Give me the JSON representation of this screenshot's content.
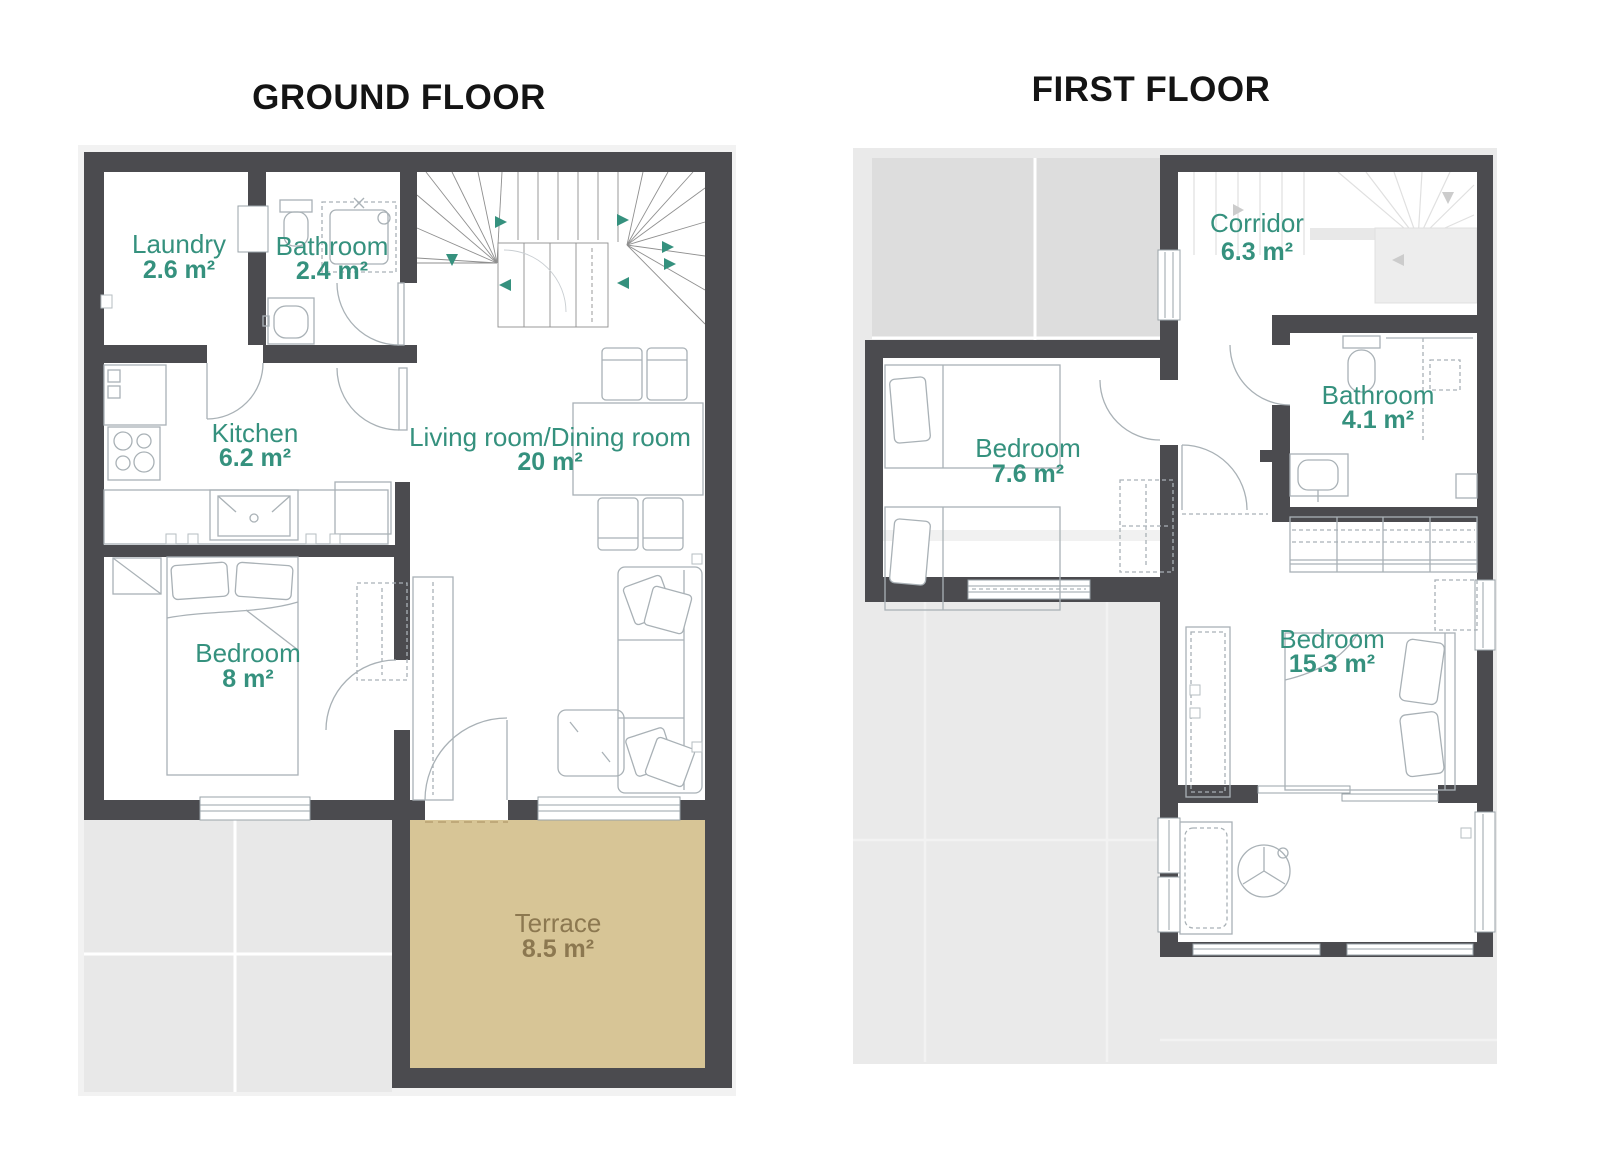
{
  "ground_floor": {
    "title": "GROUND FLOOR",
    "rooms": [
      {
        "name": "Laundry",
        "area": "2.6 m²"
      },
      {
        "name": "Bathroom",
        "area": "2.4 m²"
      },
      {
        "name": "Kitchen",
        "area": "6.2 m²"
      },
      {
        "name": "Living room/Dining room",
        "area": "20 m²"
      },
      {
        "name": "Bedroom",
        "area": "8 m²"
      },
      {
        "name": "Terrace",
        "area": "8.5 m²"
      }
    ]
  },
  "first_floor": {
    "title": "FIRST FLOOR",
    "rooms": [
      {
        "name": "Corridor",
        "area": "6.3 m²"
      },
      {
        "name": "Bathroom",
        "area": "4.1 m²"
      },
      {
        "name": "Bedroom",
        "area": "7.6 m²"
      },
      {
        "name": "Bedroom",
        "area": "15.3 m²"
      }
    ]
  },
  "colors": {
    "wall": "#4b4b4f",
    "room_label": "#35917e",
    "terrace_fill": "#d7c596",
    "terrace_label": "#8c7850",
    "garden_gray": "#e8e8e8",
    "roof_tile_gray": "#dddddd",
    "furniture_line": "#a9b1b6",
    "title_text": "#141414"
  }
}
